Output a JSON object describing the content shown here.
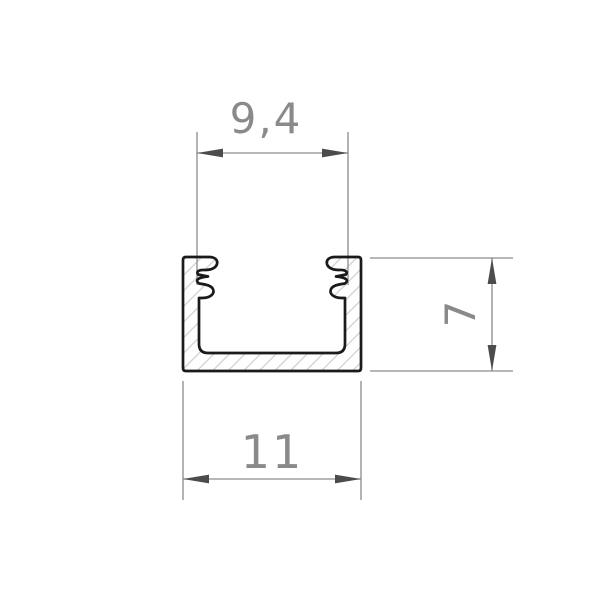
{
  "drawing": {
    "background": "#ffffff",
    "profile": {
      "outline_color": "#1a1a1a",
      "hatch_color": "#cdcdcd"
    },
    "dimension_style": {
      "line_color": "#8c8c8c",
      "arrow_color": "#4c4c4c",
      "text_color": "#8a8a8a"
    },
    "dimensions": {
      "top_width": {
        "label": "9,4"
      },
      "height": {
        "label": "7"
      },
      "bottom_width": {
        "label": "11"
      }
    }
  }
}
